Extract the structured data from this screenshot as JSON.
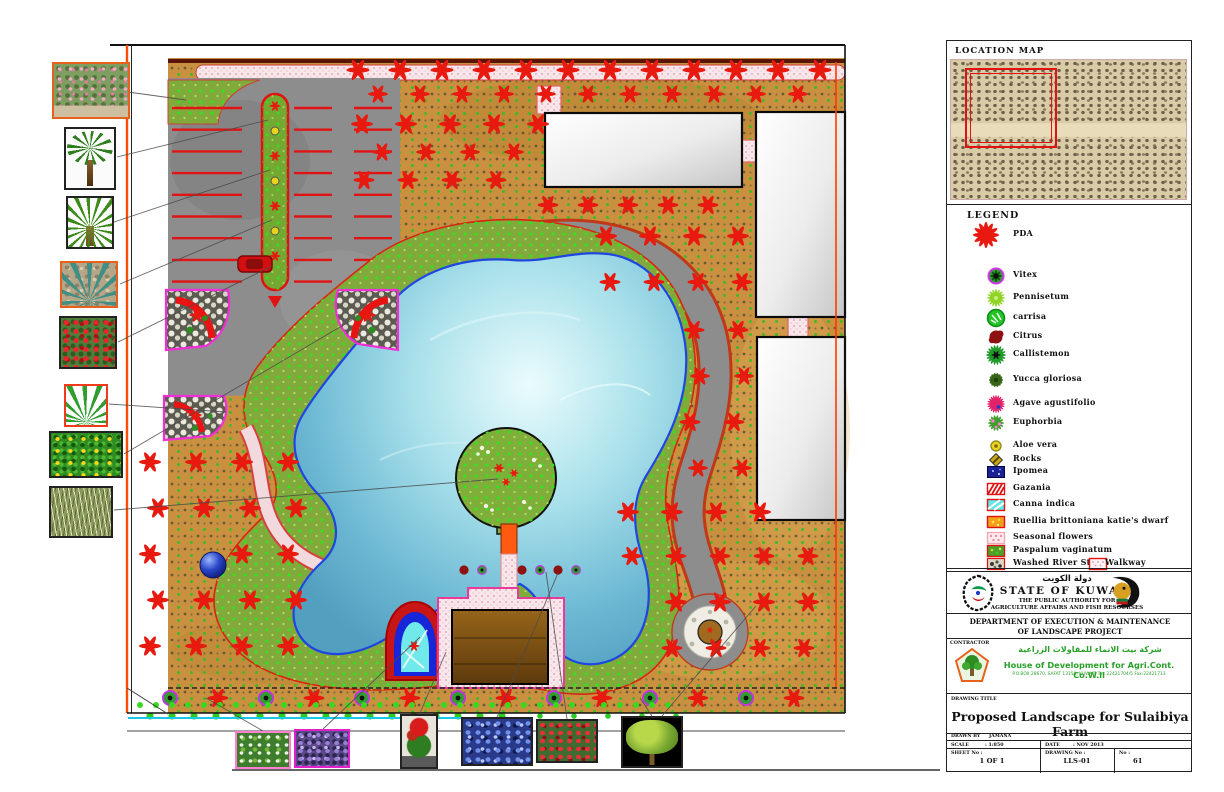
{
  "sheet": {
    "location_map_title": "LOCATION MAP",
    "legend_title": "LEGEND"
  },
  "legend": {
    "items": [
      {
        "label": "PDA",
        "icon": "pda"
      },
      {
        "label": "Vitex",
        "icon": "vitex"
      },
      {
        "label": "Pennisetum",
        "icon": "pennisetum"
      },
      {
        "label": "carrisa",
        "icon": "carrisa"
      },
      {
        "label": "Citrus",
        "icon": "citrus"
      },
      {
        "label": "Callistemon",
        "icon": "callistemon"
      },
      {
        "label": "Yucca gloriosa",
        "icon": "yucca"
      },
      {
        "label": "Agave agustifolio",
        "icon": "agave"
      },
      {
        "label": "Euphorbia",
        "icon": "euphorbia"
      },
      {
        "label": "Aloe vera",
        "icon": "aloe"
      },
      {
        "label": "Rocks",
        "icon": "rocks"
      },
      {
        "label": "Ipomea",
        "icon": "ipomea"
      },
      {
        "label": "Gazania",
        "icon": "gazania"
      },
      {
        "label": "Canna indica",
        "icon": "canna"
      },
      {
        "label": "Ruellia brittoniana katie's dwarf",
        "icon": "ruellia"
      },
      {
        "label": "Seasonal flowers",
        "icon": "seasonal"
      },
      {
        "label": "Paspalum vaginatum",
        "icon": "paspalum"
      },
      {
        "label": "Washed River Stone",
        "icon": "washed-stone",
        "extra_label": "Walkway",
        "extra_icon": "walkway"
      }
    ]
  },
  "title_block": {
    "arabic_title": "دولة الكويت",
    "state": "STATE OF KUWAIT",
    "authority_line1": "THE PUBLIC AUTHORITY FOR",
    "authority_line2": "AGRICULTURE AFFAIRS AND FISH RESOURSES",
    "department_line1": "DEPARTMENT OF EXECUTION & MAINTENANCE",
    "department_line2": "OF LANDSCAPE PROJECT",
    "contractor_label": "CONTRACTOR",
    "contractor_arabic": "شركة بيت الانماء للمقاولات الزراعية",
    "contractor_name": "House of Development for Agri.Cont. Co.W.ll",
    "contractor_details": "P.O.BOX 28670, SAFAT 13150, KUWAIT  Tel: 22421704/5  Fax:22421713",
    "drawing_title_label": "DRAWING TITLE",
    "drawing_title": "Proposed Landscape for Sulaibiya Farm",
    "drawn_by_label": "DRAWN BY",
    "drawn_by": "JAMANA",
    "scale_label": "SCALE",
    "scale_value": ": 1:850",
    "date_label": "DATE",
    "date_value": ": NOV 2013",
    "sheet_label": "SHEET No :",
    "sheet_value": "1 OF 1",
    "drawing_no_label": "DRAWING No :",
    "drawing_no_value": "LLS-01",
    "no_label": "No :",
    "no_value": "61"
  },
  "colors": {
    "star_red": "#e8190f",
    "tan_ground": "#c9913f",
    "lawn_green": "#82a93c",
    "pond_blue": "#79c7dc",
    "walkway_pink": "#f6dee2",
    "bed_magenta": "#f02fd8",
    "accent_green_text": "#2aa02a"
  }
}
